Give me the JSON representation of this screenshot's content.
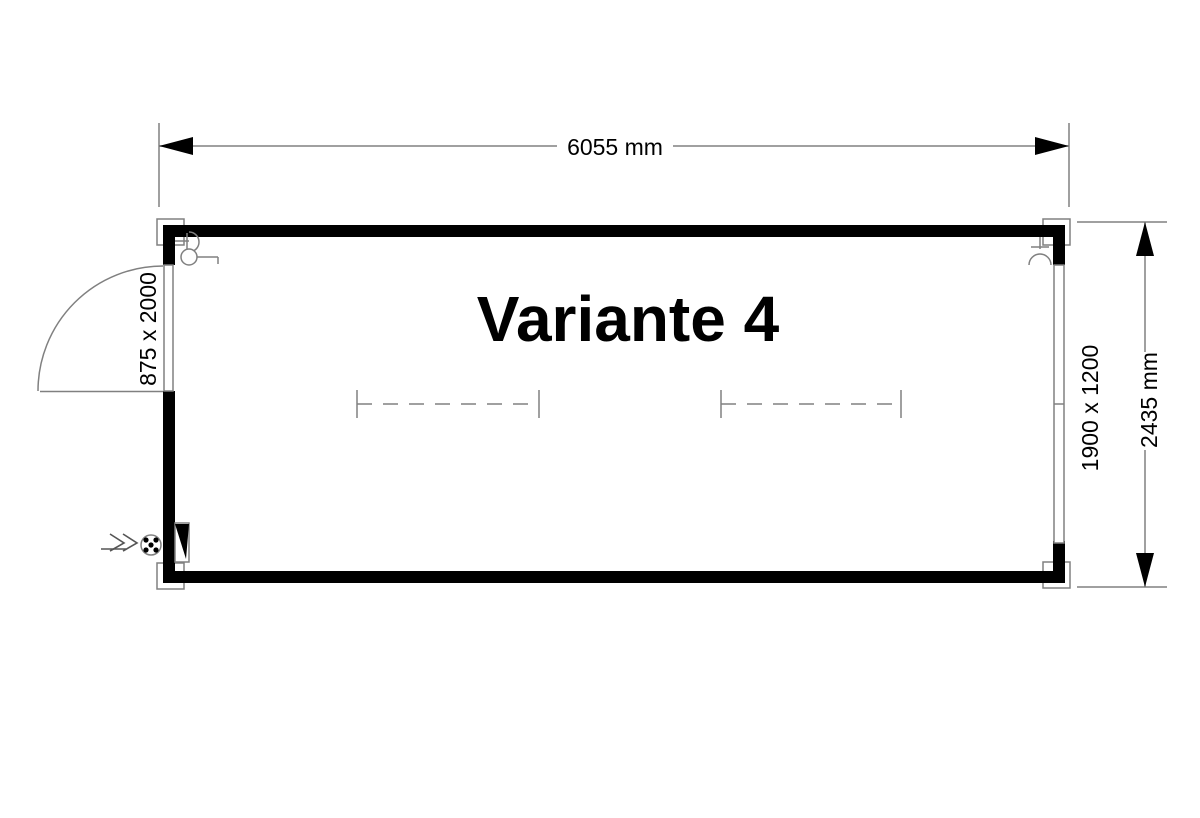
{
  "plan": {
    "title": "Variante 4",
    "dimensions": {
      "width": "6055 mm",
      "height": "2435 mm"
    },
    "door": {
      "size": "875 x 2000"
    },
    "window": {
      "size": "1900 x 1200"
    },
    "colors": {
      "wall": "#000000",
      "thin_line": "#808080",
      "text": "#000000",
      "background": "#ffffff"
    },
    "symbols": {
      "power_feed": "power-feed-arrow",
      "socket": "cee-socket",
      "distribution_box": "distribution-box-triangle",
      "wall_lamp_count": 2,
      "fluorescent_lamp_count": 2,
      "light_switch_count": 1,
      "corner_fitting_count": 4
    }
  }
}
